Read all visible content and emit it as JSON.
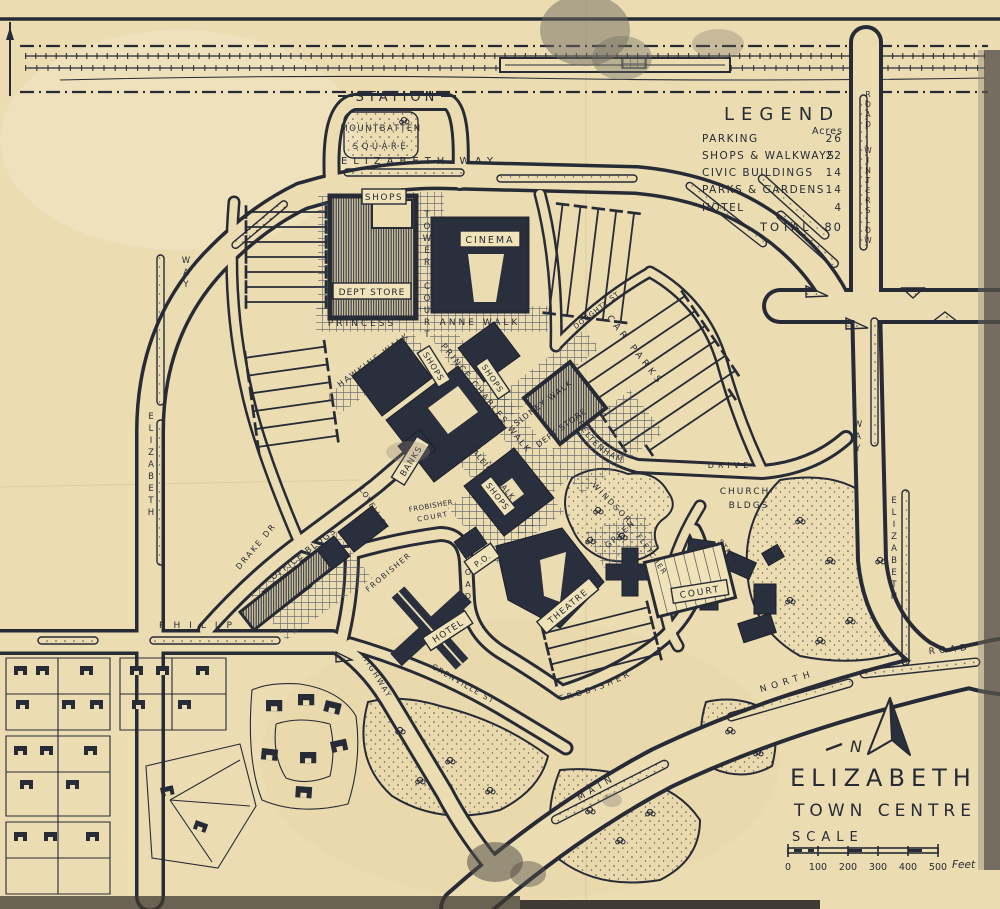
{
  "colors": {
    "paper": "#ecdcb2",
    "ink": "#262b36",
    "building": "#2a2f3d"
  },
  "legend": {
    "title": "LEGEND",
    "unit": "Acres",
    "items": [
      {
        "label": "PARKING",
        "value": "26"
      },
      {
        "label": "SHOPS & WALKWAYS",
        "value": "22"
      },
      {
        "label": "CIVIC BUILDINGS",
        "value": "14"
      },
      {
        "label": "PARKS & GARDENS",
        "value": "14"
      },
      {
        "label": "HOTEL",
        "value": "4"
      }
    ],
    "total_label": "TOTAL",
    "total_value": "80"
  },
  "title_block": {
    "line1": "ELIZABETH",
    "line2": "TOWN CENTRE",
    "scale_label": "SCALE",
    "scale_ticks": [
      "0",
      "100",
      "200",
      "300",
      "400",
      "500"
    ],
    "scale_unit": "Feet",
    "north_mark": "N"
  },
  "labels": {
    "station": "STATION",
    "mountbatten_line1": "MOUNTBATTEN",
    "mountbatten_line2": "SQUARE",
    "elizabeth_way_top": "ELIZABETH WAY",
    "shops_top": "SHOPS",
    "dept_store_top": "DEPT STORE",
    "cinema": "CINEMA",
    "tower_court": "TOWER COURT",
    "princess": "PRINCESS",
    "anne_walk": "ANNE WALK",
    "hawkins_walk": "HAWKINS WALK",
    "prince_charles_walk": "PRINCE CHARLES WALK",
    "shops_west": "SHOPS",
    "shops_east": "SHOPS",
    "shops_south": "SHOPS",
    "sidney_walk": "SIDNEY WALK",
    "dept_store_east": "DEPT STORE",
    "banks": "BANKS",
    "raleigh_walk": "RALEIGH WALK",
    "car_parks": "CAR PARKS",
    "doughty_st": "DOUGHTY ST",
    "cheltenham": "CHELTENHAM",
    "drive": "DRIVE",
    "windsor": "WINDSOR",
    "green": "GREEN",
    "church_line1": "CHURCH",
    "church_line2": "BLDGS",
    "fletcher": "FLETCHER",
    "street": "STREET",
    "court": "COURT",
    "office_bldgs": "OFFICE BLDGS",
    "drake_dr": "DRAKE DR",
    "lovell_st": "LOVELL ST",
    "frobisher_court_line1": "FROBISHER",
    "frobisher_court_line2": "COURT",
    "frobisher_name": "FROBISHER",
    "frobisher_road_word": "ROAD",
    "po": "P.O.",
    "hotel": "HOTEL",
    "theatre": "THEATRE",
    "grenville_st": "GRENVILLE ST",
    "highway": "HIGHWAY",
    "philip": "PHILIP",
    "frobisher_south": "FROBISHER",
    "main": "MAIN",
    "north": "NORTH",
    "road_east": "ROAD",
    "elizabeth_left": "ELIZABETH",
    "way_left": "WAY",
    "elizabeth_right": "ELIZABETH",
    "way_right": "WAY",
    "winterslow": "WINTERSLOW",
    "winterslow_road_word": "ROAD"
  }
}
